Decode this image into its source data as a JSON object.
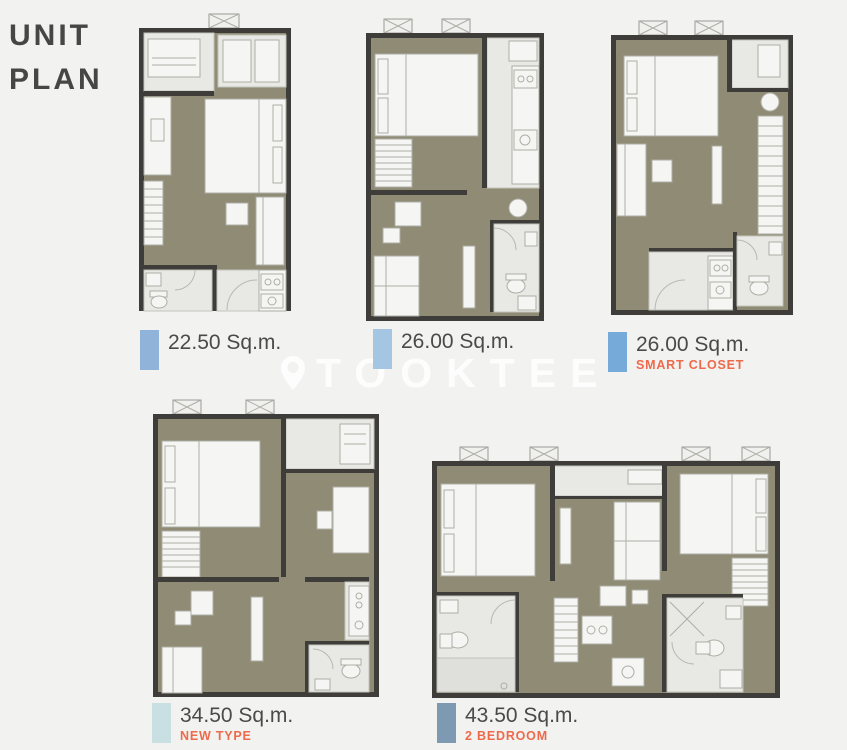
{
  "page": {
    "title_line1": "UNIT",
    "title_line2": "PLAN",
    "background": "#f2f2f0"
  },
  "watermark": {
    "text": "TOOKTEE",
    "icon": "location-pin-icon",
    "color": "#ffffff"
  },
  "palette": {
    "wall": "#3e3d39",
    "floor": "#8f8b74",
    "light_room": "#e8e8e5",
    "furniture": "#f5f5f3",
    "title_text": "#464646",
    "area_text": "#4a4a4a",
    "tag_accent": "#ee6a4c"
  },
  "units": [
    {
      "id": "unit-a",
      "area": "22.50 Sq.m.",
      "tag": "",
      "swatch": "#8fb3d9"
    },
    {
      "id": "unit-b",
      "area": "26.00 Sq.m.",
      "tag": "",
      "swatch": "#a5c6e2"
    },
    {
      "id": "unit-c",
      "area": "26.00 Sq.m.",
      "tag": "SMART CLOSET",
      "swatch": "#75aad9"
    },
    {
      "id": "unit-d",
      "area": "34.50 Sq.m.",
      "tag": "NEW TYPE",
      "swatch": "#c8e0e2"
    },
    {
      "id": "unit-e",
      "area": "43.50 Sq.m.",
      "tag": "2 BEDROOM",
      "swatch": "#7d9ab2"
    }
  ]
}
